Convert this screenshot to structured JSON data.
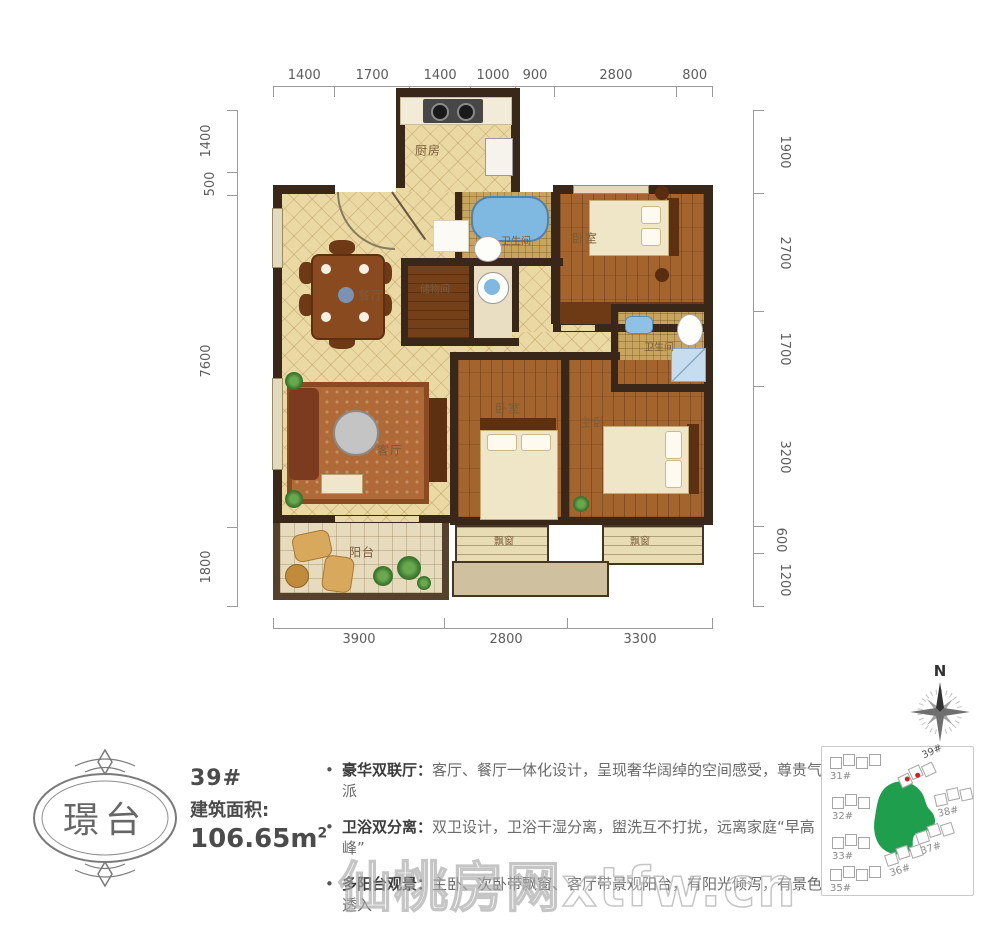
{
  "floorplan": {
    "dims_top": [
      "1400",
      "1700",
      "1400",
      "1000",
      "900",
      "2800",
      "800"
    ],
    "dims_left": [
      "1400",
      "500",
      "7600",
      "1800"
    ],
    "dims_right": [
      "1900",
      "2700",
      "1700",
      "3200",
      "600",
      "1200"
    ],
    "dims_bottom": [
      "3900",
      "2800",
      "3300"
    ],
    "rooms": [
      {
        "label": "厨房"
      },
      {
        "label": "卫生间"
      },
      {
        "label": "卧室"
      },
      {
        "label": "储物间"
      },
      {
        "label": "餐厅"
      },
      {
        "label": "卫生间"
      },
      {
        "label": "客厅"
      },
      {
        "label": "卧室"
      },
      {
        "label": "主卧"
      },
      {
        "label": "阳台"
      },
      {
        "label": "飘窗"
      },
      {
        "label": "飘窗"
      }
    ]
  },
  "info": {
    "logo_text": "璟台",
    "unit_number": "39#",
    "area_label": "建筑面积:",
    "area_value": "106.65m",
    "area_sup": "2"
  },
  "features": [
    {
      "title": "豪华双联厅：",
      "desc": "客厅、餐厅一体化设计，呈现奢华阔绰的空间感受，尊贵气派"
    },
    {
      "title": "卫浴双分离：",
      "desc": "双卫设计，卫浴干湿分离，盥洗互不打扰，远离家庭“早高峰”"
    },
    {
      "title": "多阳台观景：",
      "desc": "主卧、次卧带飘窗、客厅带景观阳台，有阳光倾泻，有景色透入"
    },
    {
      "title": "舒适厨房间：",
      "desc": "L形厨房动线，人体工学设计，让烹饪更加享受"
    }
  ],
  "siteplan": {
    "buildings": [
      {
        "label": "31#"
      },
      {
        "label": "32#"
      },
      {
        "label": "33#"
      },
      {
        "label": "35#"
      },
      {
        "label": "36#"
      },
      {
        "label": "37#"
      },
      {
        "label": "38#"
      },
      {
        "label": "39#",
        "highlighted": true
      }
    ],
    "green_color": "#1f9e4d"
  },
  "compass": {
    "north_label": "N"
  },
  "watermark": "仙桃房网xtfw.cn",
  "colors": {
    "wall": "#39271a",
    "floor_tile": "#ebd9a4",
    "wood": "#a3642e",
    "accent_green": "#1f9e4d",
    "dimension_text": "#5c5c5c"
  }
}
